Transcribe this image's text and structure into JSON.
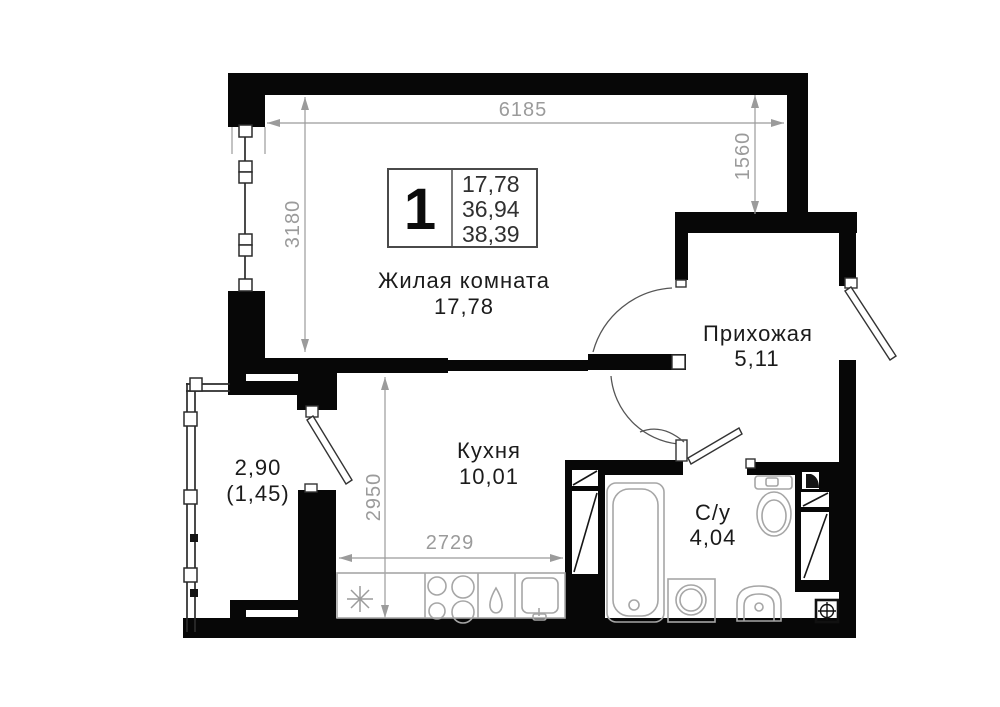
{
  "plan": {
    "title": "apartment floor plan",
    "legend": {
      "rooms_count": "1",
      "areas": [
        "17,78",
        "36,94",
        "38,39"
      ]
    },
    "rooms": {
      "living": {
        "name": "Жилая комната",
        "area": "17,78"
      },
      "kitchen": {
        "name": "Кухня",
        "area": "10,01"
      },
      "hallway": {
        "name": "Прихожая",
        "area": "5,11"
      },
      "bathroom": {
        "name": "С/у",
        "area": "4,04"
      },
      "balcony": {
        "name": "2,90",
        "area": "(1,45)"
      }
    },
    "dims": {
      "d6185": "6185",
      "d1560": "1560",
      "d3180": "3180",
      "d2950": "2950",
      "d2729": "2729"
    },
    "icons": [
      "fridge-asterisk-icon",
      "stove-icon",
      "boiler-drop-icon",
      "kitchen-sink-icon",
      "bathtub-icon",
      "toilet-icon",
      "washing-machine-icon",
      "bath-sink-icon",
      "floor-drain-icon",
      "vent-shaft-icon"
    ],
    "colors": {
      "wall": "#070707",
      "dimension": "#9b9b9b",
      "fixture": "#a6a6a6",
      "text": "#1b1b1b",
      "legend_border": "#4a4a4a"
    }
  }
}
